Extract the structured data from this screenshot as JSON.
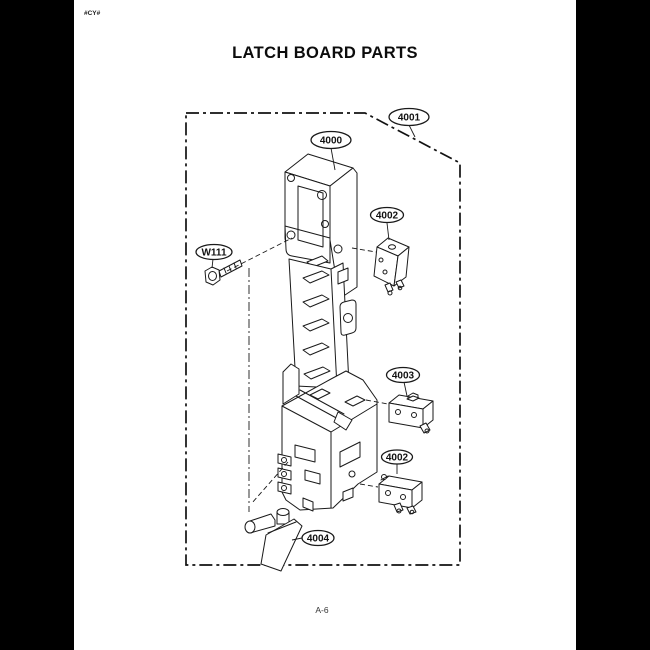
{
  "page": {
    "doc_code": "#CY#",
    "title": "LATCH BOARD PARTS",
    "page_number": "A-6"
  },
  "diagram": {
    "labels": [
      "4000",
      "4001",
      "4002",
      "W111",
      "4003",
      "4002",
      "4004"
    ]
  },
  "colors": {
    "canvas_bg": "#000000",
    "page_bg": "#ffffff",
    "line_ink": "#1a1a1a"
  }
}
